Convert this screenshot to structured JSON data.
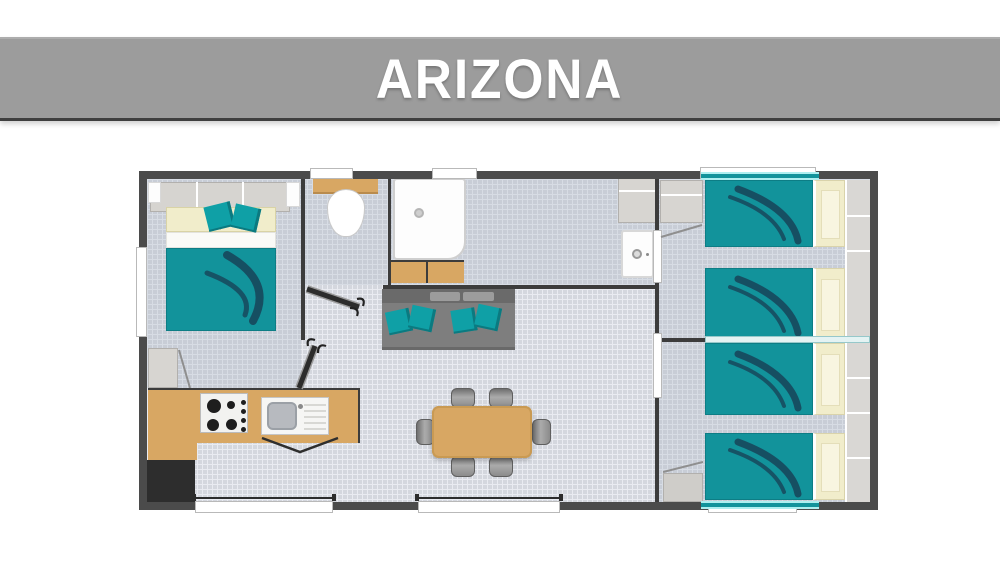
{
  "header": {
    "title": "ARIZONA"
  },
  "colors": {
    "banner": "#9c9c9c",
    "banner_text": "#ffffff",
    "wall": "#4b4b4b",
    "wall_thin": "#3c3c3c",
    "floor": "#d4d7de",
    "floor_line": "#e9ebf1",
    "teal": "#12939b",
    "teal_dark": "#17485c",
    "cushion": "#0fa0a6",
    "cream": "#f1edcb",
    "wood": "#d8a763",
    "sofa": "#7e7e7e",
    "cabinet": "#d7d5d1",
    "fridge": "#2d2d2d",
    "cyan": "#aeeff0"
  },
  "plan": {
    "rooms": [
      "master-bedroom",
      "wc",
      "shower-room",
      "entry",
      "living-dining",
      "kitchen",
      "bedroom-2",
      "bedroom-3"
    ],
    "inventory": {
      "double_beds": 1,
      "single_beds": 4,
      "dining_chairs": 6,
      "sofas": 1,
      "toilets": 1,
      "showers": 1,
      "washbasins": 2,
      "hobs": 1,
      "fridges": 1
    }
  }
}
